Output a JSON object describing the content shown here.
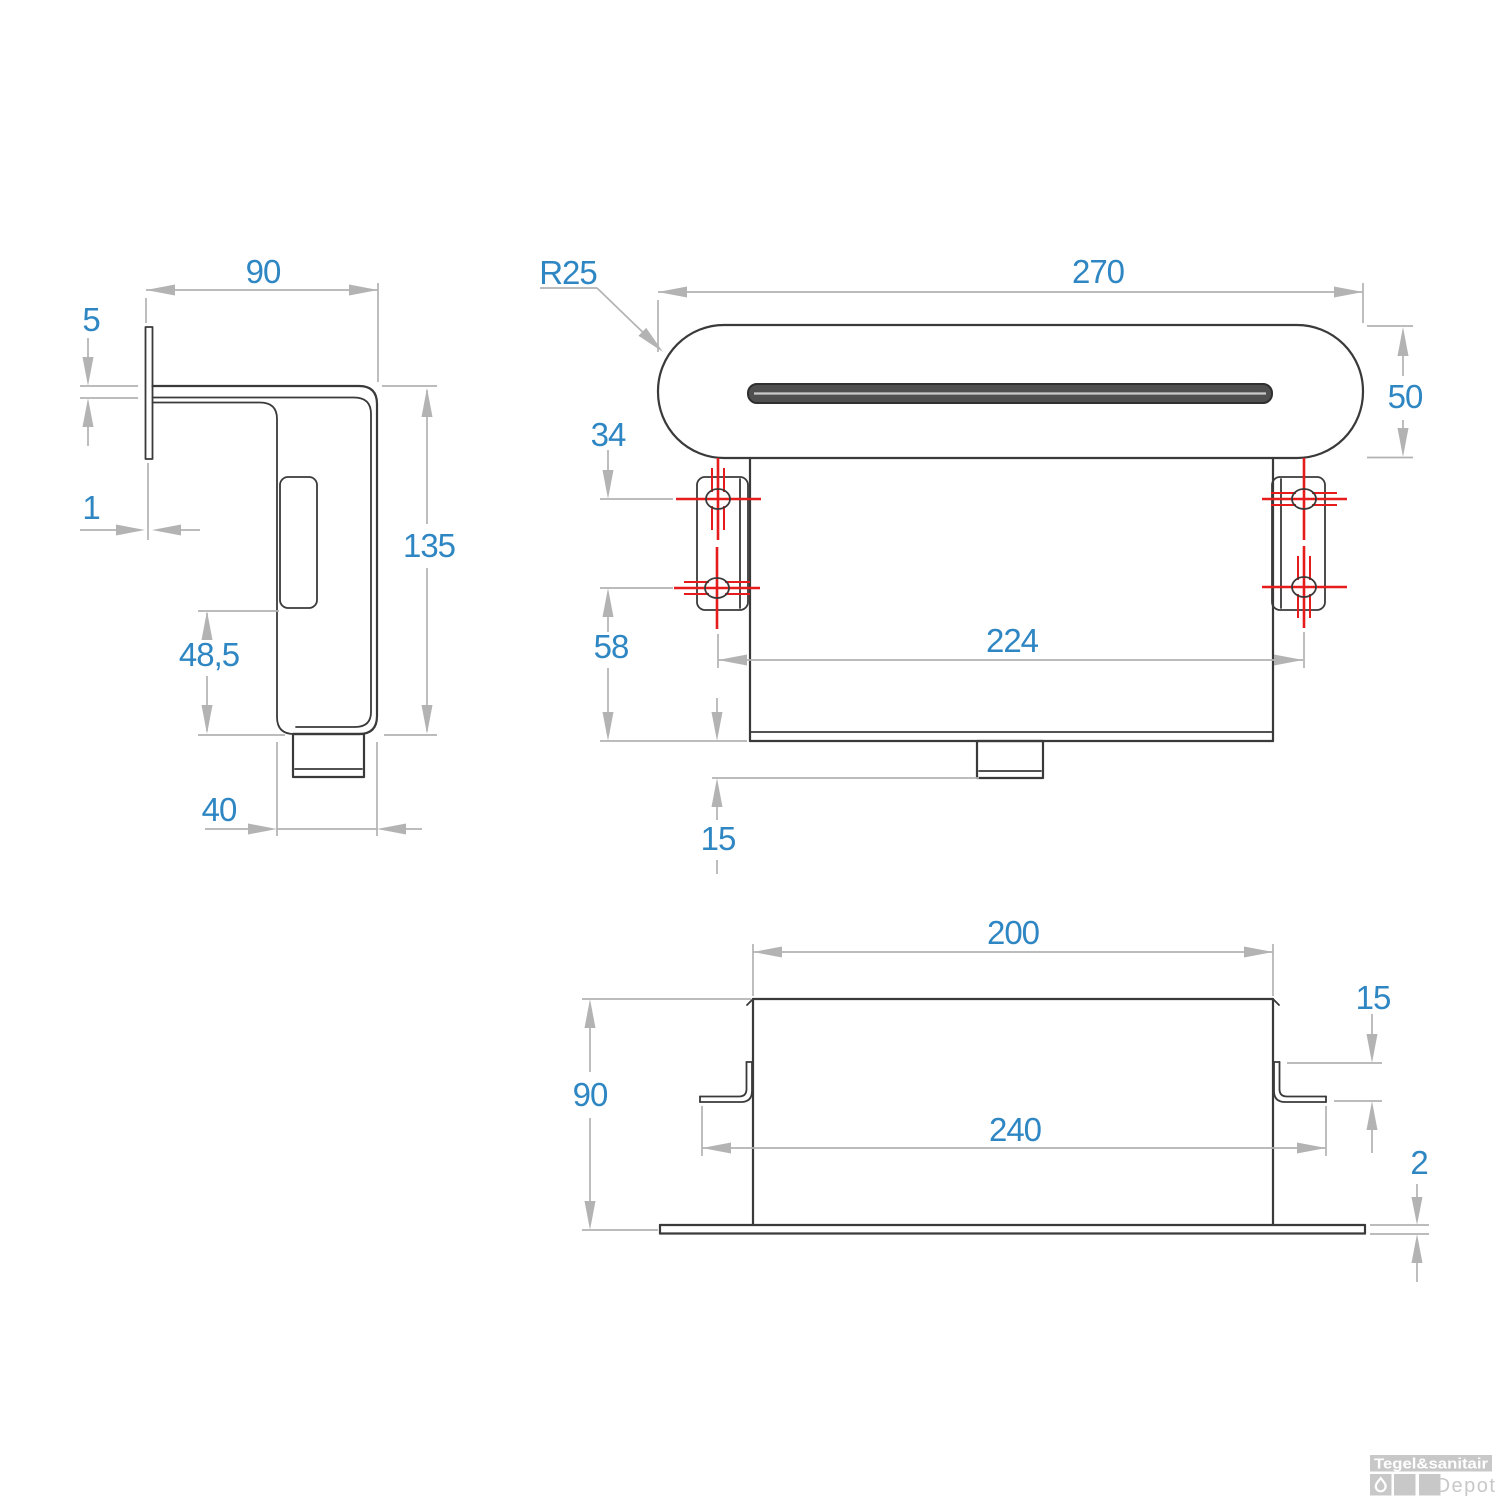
{
  "drawing": {
    "side_view": {
      "top_width": "90",
      "faceplate_thickness": "5",
      "wall_plate_thickness": "1",
      "total_height": "135",
      "bracket_bottom_offset": "48,5",
      "body_depth": "40"
    },
    "front_view": {
      "corner_radius": "R25",
      "spout_width": "270",
      "spout_height": "50",
      "screw_row_spacing": "34",
      "screw_to_bottom": "58",
      "screw_span": "224",
      "outlet_drop": "15"
    },
    "bottom_view": {
      "housing_width": "200",
      "clip_height": "15",
      "housing_depth": "90",
      "clip_span": "240",
      "plate_thickness": "2"
    }
  },
  "watermark": {
    "brand": "Tegel&sanitair",
    "sub": "Depot"
  },
  "colors": {
    "dimension_text": "#2e86c3",
    "dimension_lines": "#b3b3b3",
    "part_outline": "#3a3a3a",
    "screw_marks": "#e61c1c",
    "slot_fill": "#4f4f4f",
    "watermark_gray": "#c8c8c8",
    "background": "#ffffff"
  }
}
